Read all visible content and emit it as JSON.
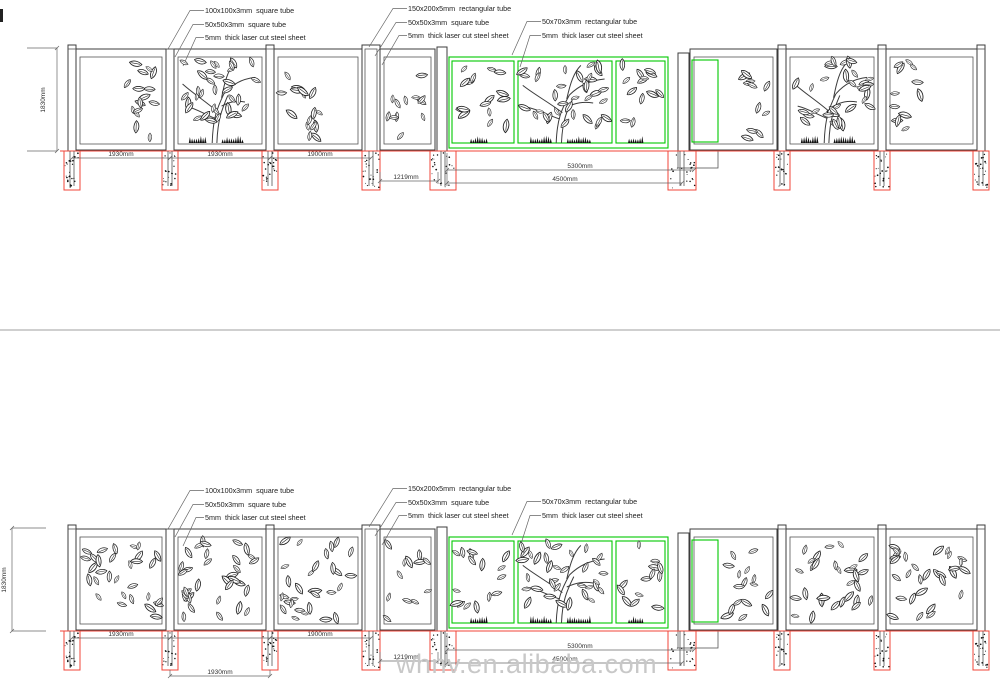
{
  "watermark": {
    "text": "whnv.en.alibaba.com"
  },
  "colors": {
    "structure_line": "#3c3c3c",
    "accent_green": "#00c800",
    "foundation_red": "#f04438",
    "watermark_gray": "#c8c8c8"
  },
  "top": {
    "callouts": {
      "square_tube_100": "100x100x3mm  square tube",
      "square_tube_50": "50x50x3mm  square tube",
      "steel_sheet_a": "5mm  thick laser cut steel sheet",
      "rect_tube_150": "150x200x5mm  rectangular tube",
      "square_tube_50b": "50x50x3mm  square tube",
      "steel_sheet_b": "5mm  thick laser cut steel sheet",
      "rect_tube_70": "50x70x3mm  rectangular tube",
      "steel_sheet_c": "5mm  thick laser cut steel sheet"
    },
    "dims": {
      "height": "1830mm",
      "bay1": "1930mm",
      "bay2": "1930mm",
      "bay3": "1900mm",
      "panel": "1219mm",
      "gate_outer": "5300mm",
      "gate_inner": "4500mm"
    }
  },
  "bottom": {
    "callouts": {
      "square_tube_100": "100x100x3mm  square tube",
      "square_tube_50": "50x50x3mm  square tube",
      "steel_sheet_a": "5mm  thick laser cut steel sheet",
      "rect_tube_150": "150x200x5mm  rectangular tube",
      "square_tube_50b": "50x50x3mm  square tube",
      "steel_sheet_b": "5mm  thick laser cut steel sheet",
      "rect_tube_70": "50x70x3mm  rectangular tube",
      "steel_sheet_c": "5mm  thick laser cut steel sheet"
    },
    "dims": {
      "height": "1830mm",
      "bay1": "1930mm",
      "bay2": "1930mm",
      "bay3": "1900mm",
      "panel": "1219mm",
      "gate_outer": "5300mm",
      "gate_inner": "4500mm"
    }
  }
}
